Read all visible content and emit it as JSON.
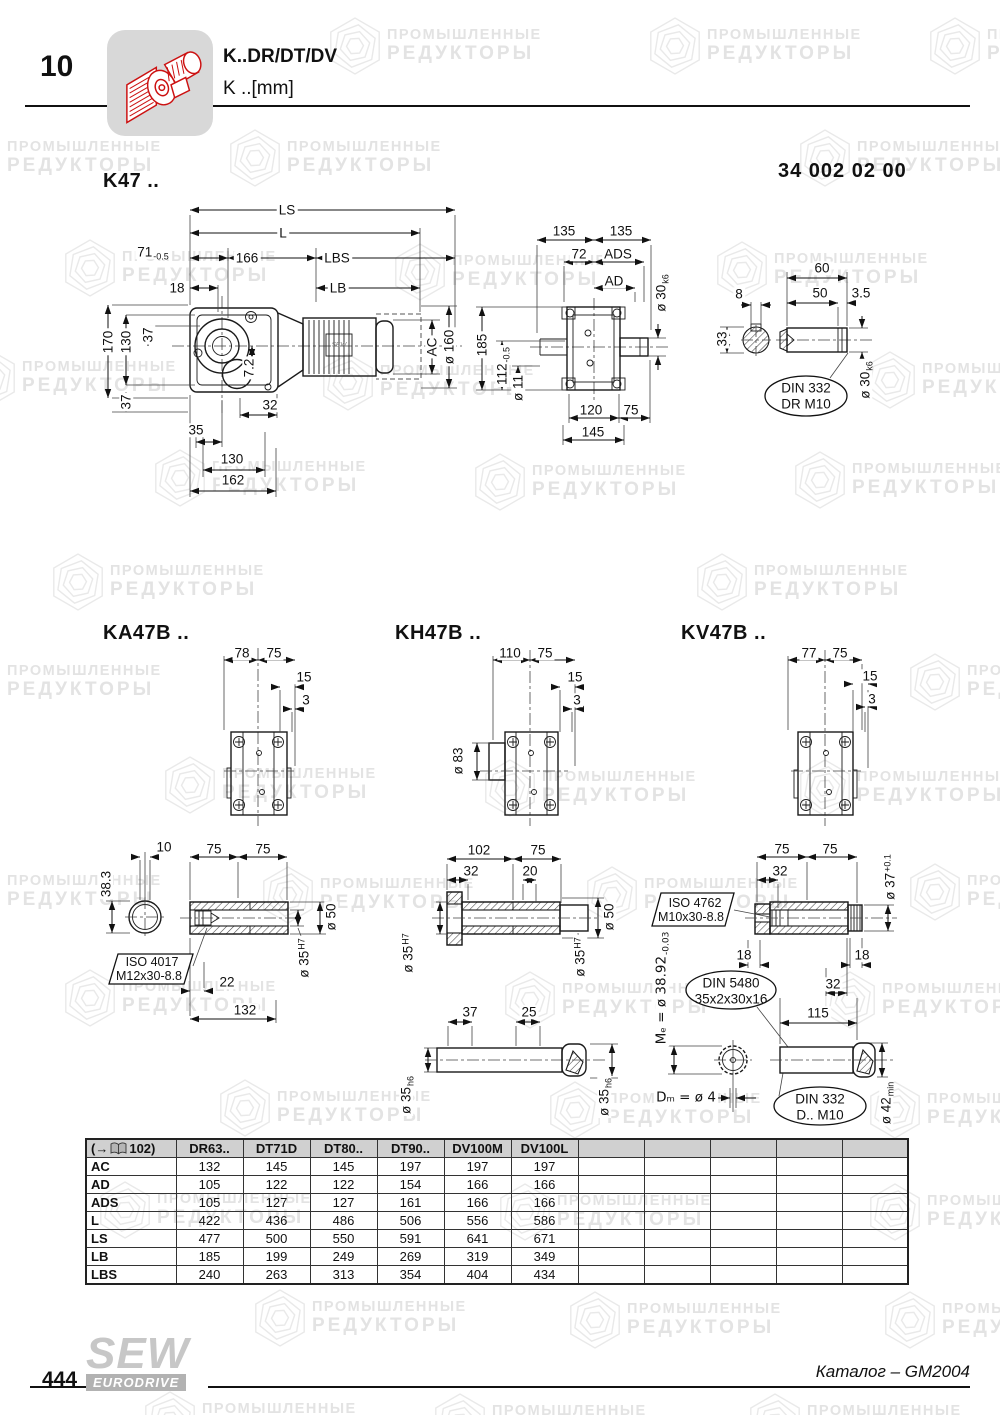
{
  "header": {
    "page_tab": "10",
    "title": "K..DR/DT/DV",
    "subtitle": "K ..[mm]",
    "part_no": "34 002 02 00"
  },
  "watermark": {
    "line1": "ПРОМЫШЛЕННЫЕ",
    "line2": "РЕДУКТОРЫ",
    "tiles": [
      [
        325,
        14
      ],
      [
        645,
        14
      ],
      [
        925,
        14
      ],
      [
        -55,
        126
      ],
      [
        225,
        126
      ],
      [
        795,
        126
      ],
      [
        60,
        236
      ],
      [
        390,
        240
      ],
      [
        712,
        238
      ],
      [
        -40,
        346
      ],
      [
        318,
        350
      ],
      [
        860,
        348
      ],
      [
        150,
        446
      ],
      [
        470,
        450
      ],
      [
        790,
        448
      ],
      [
        48,
        550
      ],
      [
        692,
        550
      ],
      [
        -55,
        650
      ],
      [
        905,
        650
      ],
      [
        160,
        753
      ],
      [
        480,
        756
      ],
      [
        795,
        756
      ],
      [
        -55,
        860
      ],
      [
        258,
        863
      ],
      [
        582,
        863
      ],
      [
        905,
        860
      ],
      [
        60,
        966
      ],
      [
        500,
        968
      ],
      [
        820,
        968
      ],
      [
        215,
        1076
      ],
      [
        545,
        1078
      ],
      [
        865,
        1078
      ],
      [
        95,
        1178
      ],
      [
        495,
        1180
      ],
      [
        865,
        1180
      ],
      [
        250,
        1286
      ],
      [
        565,
        1288
      ],
      [
        880,
        1288
      ],
      [
        140,
        1388
      ],
      [
        430,
        1390
      ],
      [
        745,
        1390
      ]
    ]
  },
  "k47": {
    "title": "K47 ..",
    "motor_logo": "SEW",
    "dims": {
      "ls": "LS",
      "l": "L",
      "n71": "71",
      "n71t": "-0.5",
      "n166": "166",
      "lbs": "LBS",
      "n18": "18",
      "lb": "LB",
      "n170": "170",
      "n130": "130",
      "n37a": "37",
      "n37b": "37",
      "n72": "7.2",
      "ac": "AC",
      "n160": "ø 160",
      "n32": "32",
      "n35": "35",
      "n130b": "130",
      "n162": "162",
      "n135a": "135",
      "n135b": "135",
      "n72m": "72",
      "ads": "ADS",
      "ad": "AD",
      "n30": "ø 30",
      "n30t": "k6",
      "n185": "185",
      "n112": "112",
      "n112t": "-0.5",
      "n11": "ø 11",
      "n120": "120",
      "n75": "75",
      "n145": "145",
      "n8": "8",
      "n33": "33",
      "n60": "60",
      "n50": "50",
      "n35s": "3.5",
      "n30b": "ø 30",
      "n30bt": "k6",
      "din332": "DIN 332",
      "din332b": "DR M10"
    }
  },
  "ka47b": {
    "title": "KA47B ..",
    "dims": {
      "n78": "78",
      "n75a": "75",
      "n15": "15",
      "n3": "3",
      "n10": "10",
      "n75b": "75",
      "n75c": "75",
      "n383": "38.3",
      "n50": "ø 50",
      "n35": "ø 35",
      "n35t": "H7",
      "iso": "ISO 4017",
      "isob": "M12x30-8.8",
      "n22": "22",
      "n132": "132"
    }
  },
  "kh47b": {
    "title": "KH47B ..",
    "dims": {
      "n110": "110",
      "n75a": "75",
      "n15": "15",
      "n3": "3",
      "n83": "ø 83",
      "n102": "102",
      "n75b": "75",
      "n32": "32",
      "n20": "20",
      "n35a": "ø 35",
      "n35at": "H7",
      "n50": "ø 50",
      "n35b": "ø 35",
      "n35bt": "H7",
      "n37": "37",
      "n25": "25",
      "n35c": "ø 35",
      "n35ct": "h6",
      "n35d": "ø 35",
      "n35dt": "h6"
    }
  },
  "kv47b": {
    "title": "KV47B ..",
    "dims": {
      "n77": "77",
      "n75a": "75",
      "n15": "15",
      "n3": "3",
      "n75b": "75",
      "n75c": "75",
      "n32a": "32",
      "n37": "ø 37",
      "n37t": "+0.1",
      "iso": "ISO 4762",
      "isob": "M10x30-8.8",
      "n18a": "18",
      "n18b": "18",
      "n32b": "32",
      "n115": "115",
      "me": "Mₑ = ø 38.92",
      "met": "-0.03",
      "din5480": "DIN 5480",
      "din5480b": "35x2x30x16",
      "dm": "Dₘ = ø 4",
      "din332": "DIN 332",
      "din332b": "D.. M10",
      "n42": "ø 42",
      "n42t": "min"
    }
  },
  "table": {
    "ref_open": "(→",
    "ref_page": "102)",
    "columns": [
      "DR63..",
      "DT71D",
      "DT80..",
      "DT90..",
      "DV100M",
      "DV100L"
    ],
    "empty_columns": 5,
    "rows": [
      [
        "AC",
        "132",
        "145",
        "145",
        "197",
        "197",
        "197"
      ],
      [
        "AD",
        "105",
        "122",
        "122",
        "154",
        "166",
        "166"
      ],
      [
        "ADS",
        "105",
        "127",
        "127",
        "161",
        "166",
        "166"
      ],
      [
        "L",
        "422",
        "436",
        "486",
        "506",
        "556",
        "586"
      ],
      [
        "LS",
        "477",
        "500",
        "550",
        "591",
        "641",
        "671"
      ],
      [
        "LB",
        "185",
        "199",
        "249",
        "269",
        "319",
        "349"
      ],
      [
        "LBS",
        "240",
        "263",
        "313",
        "354",
        "404",
        "434"
      ]
    ]
  },
  "footer": {
    "page_number": "444",
    "logo_top": "SEW",
    "logo_band": "EURODRIVE",
    "catalog_ref": "Каталог – GM2004"
  }
}
